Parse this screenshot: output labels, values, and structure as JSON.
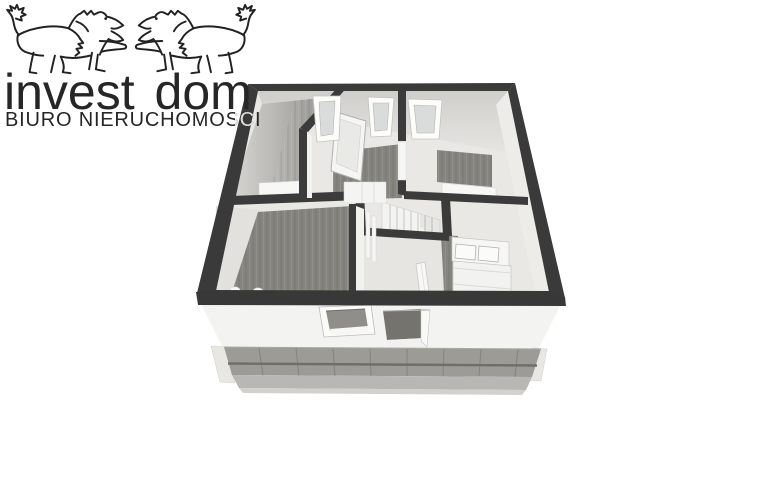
{
  "logo": {
    "mark": "twin-lions-icon",
    "title": "invest dom",
    "subtitle": "BIURO NIERUCHOMOSCI"
  },
  "floorplan": {
    "type": "3d-floor-plan-render",
    "elements": [
      "exterior-walls",
      "interior-walls",
      "staircase",
      "stair-landing",
      "banister",
      "double-bed",
      "pillows",
      "top-wall-windows",
      "open-doors",
      "wood-flooring",
      "dresser",
      "lower-floor-facade",
      "facade-window",
      "facade-door",
      "terrace-tiles",
      "terrace-base"
    ],
    "colors": {
      "wall": "#3a3a3a",
      "wood_floor": "#85847f",
      "light_floor": "#e9e8e5",
      "wall_face": "#d5d4d1",
      "facade": "#f3f3f1",
      "terrace": "#9c9b96",
      "terrace_base": "#b8b7b3",
      "glass": "#8f8e89",
      "background": "#ffffff",
      "logo_text": "#262626"
    }
  }
}
